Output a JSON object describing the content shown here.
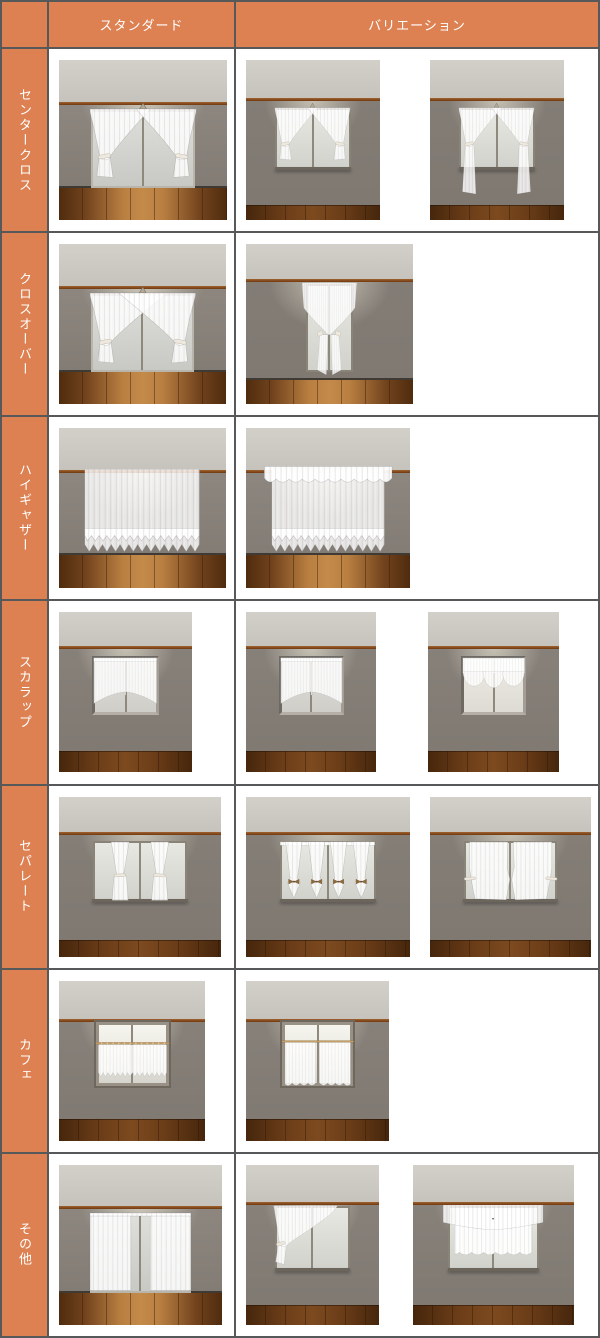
{
  "title": "レースカーテン スタイル比較表",
  "colors": {
    "accent_orange": "#dd8152",
    "border_gray": "#57585a",
    "wall_gray": "#8b857e",
    "ceiling_gray": "#cbc9c2",
    "trim_brown": "#7c4018",
    "floor_brown": "#6b3d18",
    "curtain_white": "#ffffff"
  },
  "header": {
    "corner": "",
    "columns": [
      {
        "key": "standard",
        "label": "スタンダード"
      },
      {
        "key": "variation",
        "label": "バリエーション"
      }
    ]
  },
  "rows": [
    {
      "key": "center-cross",
      "label": "センタークロス",
      "standard": [
        {
          "style": "center-cross",
          "window": "terrace",
          "w": 168
        }
      ],
      "variation": [
        {
          "style": "center-cross",
          "window": "small",
          "w": 134
        },
        {
          "style": "center-cross-long",
          "window": "small",
          "w": 134
        }
      ],
      "gap": 50
    },
    {
      "key": "crossover",
      "label": "クロスオーバー",
      "standard": [
        {
          "style": "crossover",
          "window": "terrace",
          "w": 167
        }
      ],
      "variation": [
        {
          "style": "crossover-narrow",
          "window": "narrow",
          "w": 167
        }
      ],
      "gap": 20
    },
    {
      "key": "high-gather",
      "label": "ハイギャザー",
      "standard": [
        {
          "style": "high-gather",
          "window": "hidden",
          "w": 167
        }
      ],
      "variation": [
        {
          "style": "high-gather-valance",
          "window": "hidden",
          "w": 164
        }
      ],
      "gap": 20
    },
    {
      "key": "scallop",
      "label": "スカラップ",
      "standard": [
        {
          "style": "scallop",
          "window": "recessed",
          "w": 133
        }
      ],
      "variation": [
        {
          "style": "scallop",
          "window": "recessed",
          "w": 130
        },
        {
          "style": "scallop-balloon",
          "window": "recessed-clear",
          "w": 131
        }
      ],
      "gap": 52
    },
    {
      "key": "separate",
      "label": "セパレート",
      "standard": [
        {
          "style": "separate",
          "window": "small5",
          "w": 162
        }
      ],
      "variation": [
        {
          "style": "separate-bows",
          "window": "small5",
          "w": 164
        },
        {
          "style": "separate-side",
          "window": "small5",
          "w": 161
        }
      ],
      "gap": 20
    },
    {
      "key": "cafe",
      "label": "カフェ",
      "standard": [
        {
          "style": "cafe",
          "window": "cafe",
          "w": 146
        }
      ],
      "variation": [
        {
          "style": "cafe-wavy",
          "window": "cafe",
          "w": 143
        }
      ],
      "gap": 20
    },
    {
      "key": "other",
      "label": "その他",
      "standard": [
        {
          "style": "panels-straight",
          "window": "terrace",
          "w": 163
        }
      ],
      "variation": [
        {
          "style": "swag-diagonal",
          "window": "small7",
          "w": 133
        },
        {
          "style": "valance-layered",
          "window": "small7",
          "w": 161
        }
      ],
      "gap": 34
    }
  ]
}
